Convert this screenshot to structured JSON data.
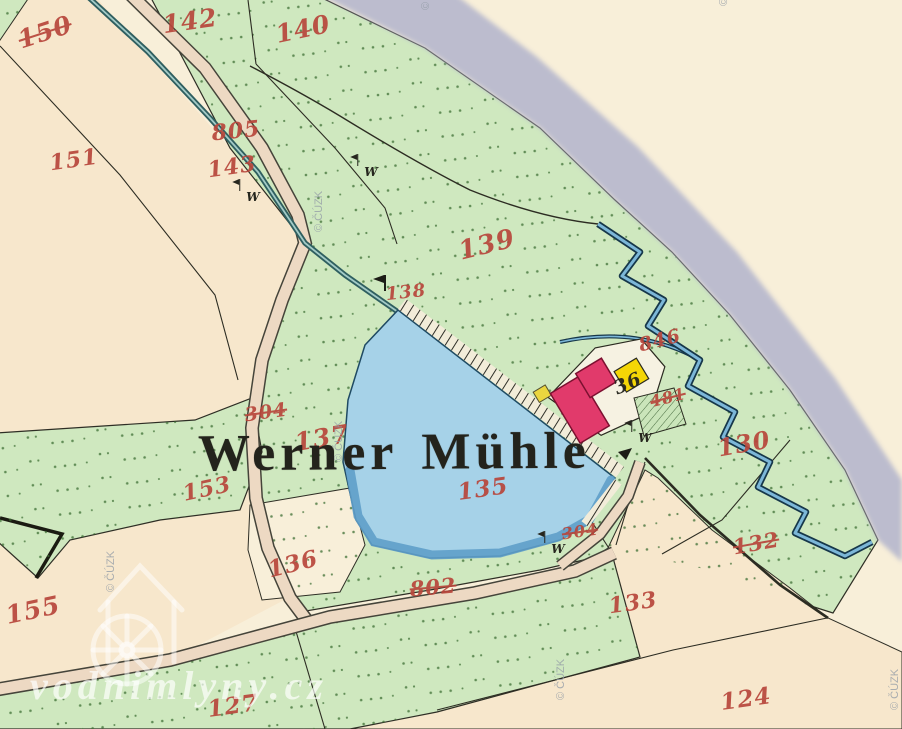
{
  "map": {
    "title": "Werner Mühle",
    "meadow_glyph": "W",
    "parcel_labels": [
      {
        "text": "150",
        "x": 45,
        "y": 32,
        "size": 25,
        "rot": -18,
        "struck": true
      },
      {
        "text": "142",
        "x": 190,
        "y": 21,
        "size": 25,
        "rot": -8
      },
      {
        "text": "140",
        "x": 303,
        "y": 29,
        "size": 25,
        "rot": -12
      },
      {
        "text": "151",
        "x": 74,
        "y": 160,
        "size": 22,
        "rot": -8
      },
      {
        "text": "805",
        "x": 236,
        "y": 131,
        "size": 22,
        "rot": -6
      },
      {
        "text": "143",
        "x": 232,
        "y": 167,
        "size": 22,
        "rot": -8
      },
      {
        "text": "139",
        "x": 487,
        "y": 245,
        "size": 26,
        "rot": -14
      },
      {
        "text": "138",
        "x": 406,
        "y": 293,
        "size": 18,
        "rot": -6
      },
      {
        "text": "846",
        "x": 660,
        "y": 341,
        "size": 19,
        "rot": -14
      },
      {
        "text": "36",
        "x": 628,
        "y": 384,
        "size": 19,
        "rot": -24,
        "ink": "black"
      },
      {
        "text": "481",
        "x": 668,
        "y": 398,
        "size": 16,
        "rot": -14,
        "struck": true
      },
      {
        "text": "130",
        "x": 744,
        "y": 444,
        "size": 24,
        "rot": -10
      },
      {
        "text": "132",
        "x": 756,
        "y": 543,
        "size": 21,
        "rot": -10,
        "struck": true
      },
      {
        "text": "153",
        "x": 207,
        "y": 489,
        "size": 22,
        "rot": -12
      },
      {
        "text": "304",
        "x": 266,
        "y": 413,
        "size": 19,
        "rot": -8,
        "struck": true
      },
      {
        "text": "137",
        "x": 322,
        "y": 438,
        "size": 25,
        "rot": -10
      },
      {
        "text": "135",
        "x": 483,
        "y": 489,
        "size": 23,
        "rot": -8
      },
      {
        "text": "304",
        "x": 580,
        "y": 532,
        "size": 16,
        "rot": -8,
        "struck": true
      },
      {
        "text": "802",
        "x": 433,
        "y": 587,
        "size": 21,
        "rot": -5,
        "struck": true
      },
      {
        "text": "136",
        "x": 293,
        "y": 564,
        "size": 23,
        "rot": -14
      },
      {
        "text": "155",
        "x": 33,
        "y": 610,
        "size": 25,
        "rot": -12
      },
      {
        "text": "133",
        "x": 633,
        "y": 603,
        "size": 22,
        "rot": -8
      },
      {
        "text": "127",
        "x": 233,
        "y": 706,
        "size": 23,
        "rot": -8
      },
      {
        "text": "124",
        "x": 746,
        "y": 699,
        "size": 23,
        "rot": -8
      }
    ],
    "meadow_marks": [
      {
        "x": 253,
        "y": 197
      },
      {
        "x": 371,
        "y": 172
      },
      {
        "x": 645,
        "y": 438
      },
      {
        "x": 558,
        "y": 549
      }
    ],
    "flag_marker": {
      "x": 384,
      "y": 291
    }
  },
  "watermark": {
    "site_label": "vodnimlyny.cz",
    "copyright_label": "© ČÚZK",
    "copyright_positions": [
      {
        "x": 420,
        "y": 10
      },
      {
        "x": 718,
        "y": 6
      },
      {
        "x": 313,
        "y": 232
      },
      {
        "x": 333,
        "y": 462
      },
      {
        "x": 105,
        "y": 592
      },
      {
        "x": 555,
        "y": 700
      },
      {
        "x": 889,
        "y": 710
      }
    ]
  },
  "palette": {
    "red_ink": "#b8463b",
    "black_ink": "#26261e",
    "meadow": "#cfe8bf",
    "field": "#f8efd9",
    "field_warm": "#f7e7cc",
    "pond": "#a6d2e8",
    "pond_shade": "#5f9fc9",
    "river": "#b6b7cd",
    "road": "#edd9c3",
    "building_red": "#e13a6b",
    "building_yellow": "#f4d606",
    "stream": "#2f5f60"
  }
}
